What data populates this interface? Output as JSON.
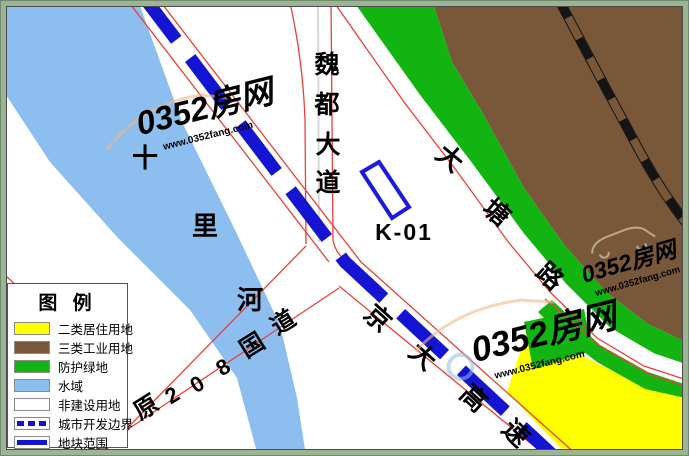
{
  "map_title_note": "urban planning plot map",
  "colors": {
    "water": "#8CBEF0",
    "industrial_brown": "#785838",
    "protective_green": "#12B412",
    "residential_yellow": "#FFFF00",
    "non_construction_white": "#FFFFFF",
    "road_red": "#E8403C",
    "boundary_blue": "#1414D2",
    "plot_outline_blue": "#1A1AE0",
    "frame_green": "#9CB494",
    "railway_black": "#141414",
    "centerline_gray": "#D9D9D9",
    "watermark_blue": "rgba(150,187,226,0.55)",
    "watermark_orange": "rgba(242,185,135,0.60)",
    "watermark_cream": "rgba(240,233,219,0.55)"
  },
  "labels": {
    "river": "十里河",
    "weidu_avenue": "魏都大道",
    "datang_road": "大塘路",
    "jingda_expressway": "京大高速",
    "national_road_208": "原208国道",
    "plot_id": "K-01"
  },
  "legend": {
    "title": "图 例",
    "items": [
      {
        "label": "二类居住用地",
        "color": "#FFFF00"
      },
      {
        "label": "三类工业用地",
        "color": "#785838"
      },
      {
        "label": "防护绿地",
        "color": "#12B412"
      },
      {
        "label": "水域",
        "color": "#8CBEF0"
      },
      {
        "label": "非建设用地",
        "color": "#FFFFFF"
      },
      {
        "label": "城市开发边界",
        "color": "#1414D2"
      },
      {
        "label": "地块范围",
        "color": "#1414D2"
      }
    ]
  },
  "watermark": {
    "brand": "0352房网",
    "url": "www.0352fang.com"
  }
}
